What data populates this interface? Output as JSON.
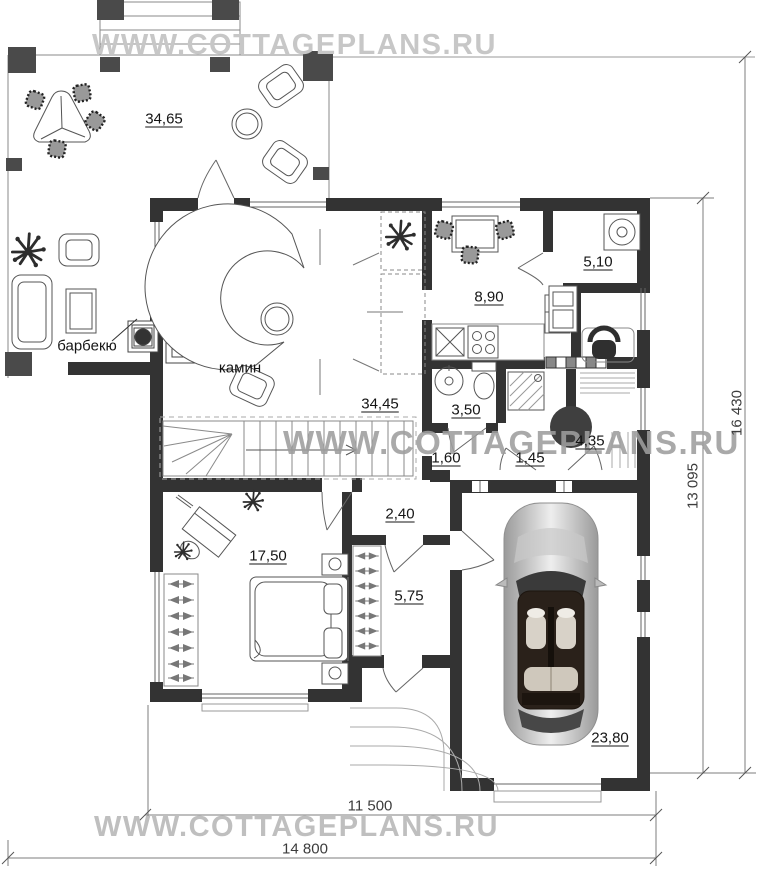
{
  "watermark": {
    "text": "WWW.COTTAGEPLANS.RU"
  },
  "rooms": {
    "terrace": {
      "area": "34,65"
    },
    "living_room": {
      "area": "34,45"
    },
    "kitchen": {
      "area": "8,90"
    },
    "utility": {
      "area": "5,10"
    },
    "bathroom": {
      "area": "3,50"
    },
    "sauna": {
      "area": "4,35"
    },
    "hall_left": {
      "area": "1,60"
    },
    "hall_right": {
      "area": "1,45"
    },
    "corridor": {
      "area": "2,40"
    },
    "bedroom": {
      "area": "17,50"
    },
    "wardrobe": {
      "area": "5,75"
    },
    "garage": {
      "area": "23,80"
    }
  },
  "labels": {
    "barbecue": "барбекю",
    "fireplace": "камин"
  },
  "dimensions": {
    "height_total": "16 430",
    "height_house": "13 095",
    "width_house": "11 500",
    "width_total": "14 800"
  },
  "colors": {
    "wall": "#333333",
    "column": "#4a4a4a",
    "watermark": "#c7c7c7"
  }
}
